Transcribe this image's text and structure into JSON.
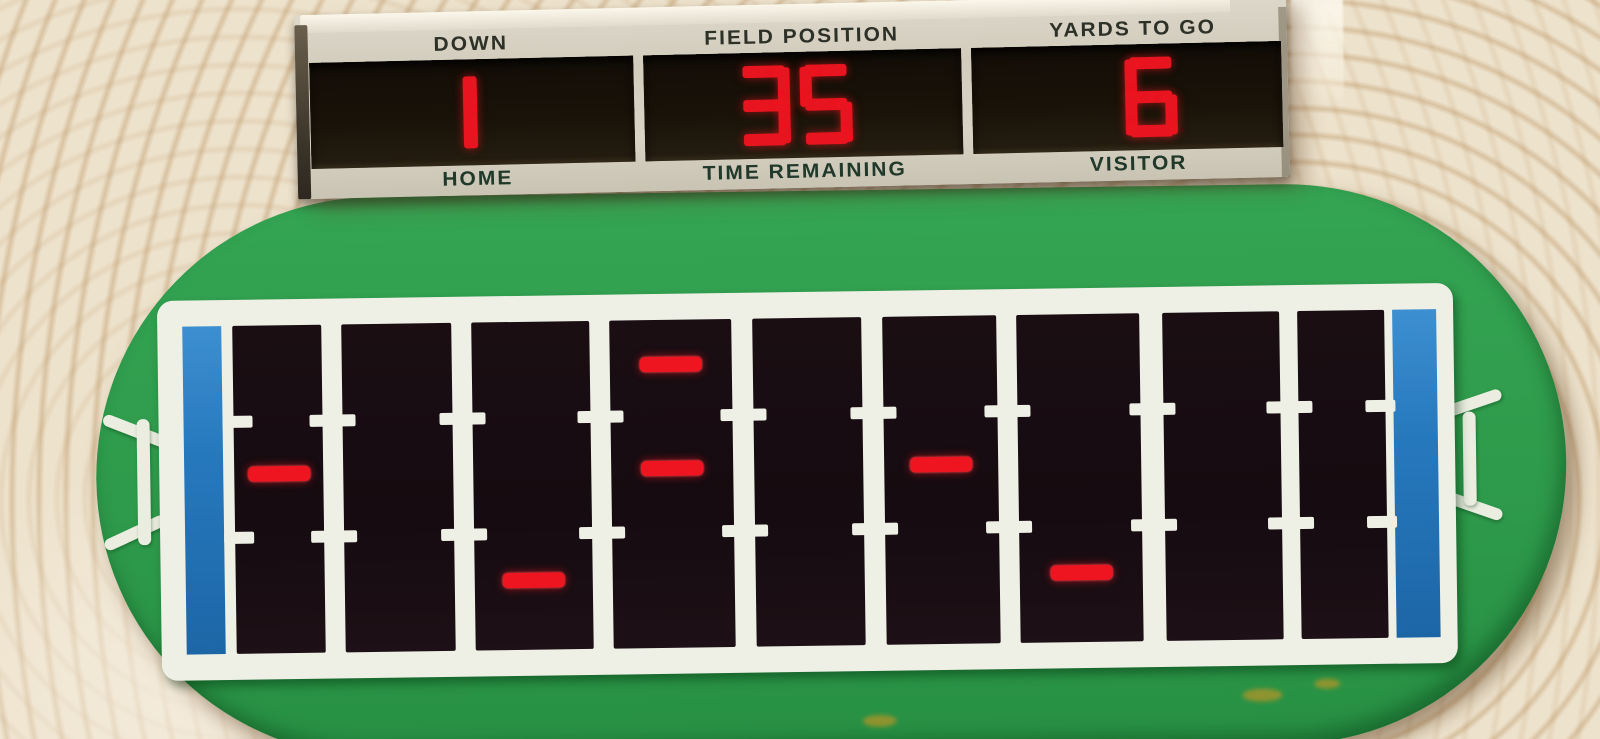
{
  "device": {
    "name": "Handheld electronic football game",
    "display_type": "LED"
  },
  "scoreboard": {
    "windows": [
      {
        "top_label": "DOWN",
        "bottom_label": "HOME",
        "value": "1"
      },
      {
        "top_label": "FIELD POSITION",
        "bottom_label": "TIME REMAINING",
        "value": "35"
      },
      {
        "top_label": "YARDS TO GO",
        "bottom_label": "VISITOR",
        "value": "6"
      }
    ],
    "led_color": "#e8141f"
  },
  "game_state": {
    "down": "1",
    "field_position": "35",
    "yards_to_go": "6"
  },
  "field": {
    "columns": 9,
    "rows": [
      "top",
      "middle",
      "bottom"
    ],
    "players": [
      {
        "column": 1,
        "row": "middle"
      },
      {
        "column": 3,
        "row": "bottom"
      },
      {
        "column": 4,
        "row": "top"
      },
      {
        "column": 4,
        "row": "middle"
      },
      {
        "column": 6,
        "row": "middle"
      },
      {
        "column": 7,
        "row": "bottom"
      }
    ],
    "colors": {
      "turf_green": "#2e9a4b",
      "endzone_blue": "#2678bd",
      "field_black": "#150b10",
      "line_white": "#eef0e6",
      "player_led_red": "#ee1420",
      "casing_cream": "#ede2cc"
    }
  }
}
